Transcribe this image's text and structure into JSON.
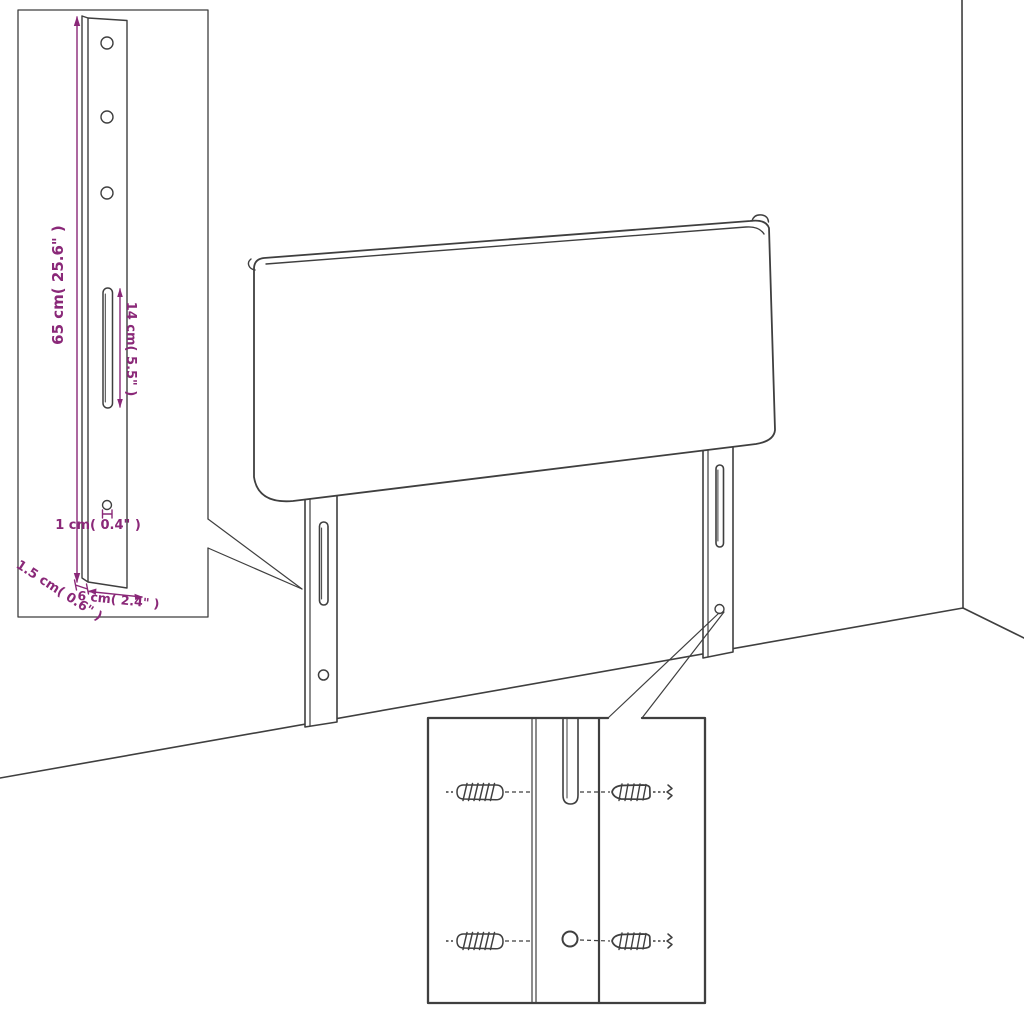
{
  "diagram": {
    "kind": "furniture-assembly-dimension-diagram",
    "subject": "upholstered-headboard-with-two-mounting-leg-brackets",
    "colors": {
      "background": "#ffffff",
      "outline": "#3f3f3f",
      "dimension": "#8a2878"
    },
    "bracket_detail": {
      "height_label": "65 cm( 25.6\" )",
      "slot_label": "14 cm( 5.5\" )",
      "hole_label": "1 cm( 0.4\" )",
      "thickness_label": "1.5 cm( 0.6\" )",
      "width_label": "6 cm( 2.4\" )"
    }
  }
}
